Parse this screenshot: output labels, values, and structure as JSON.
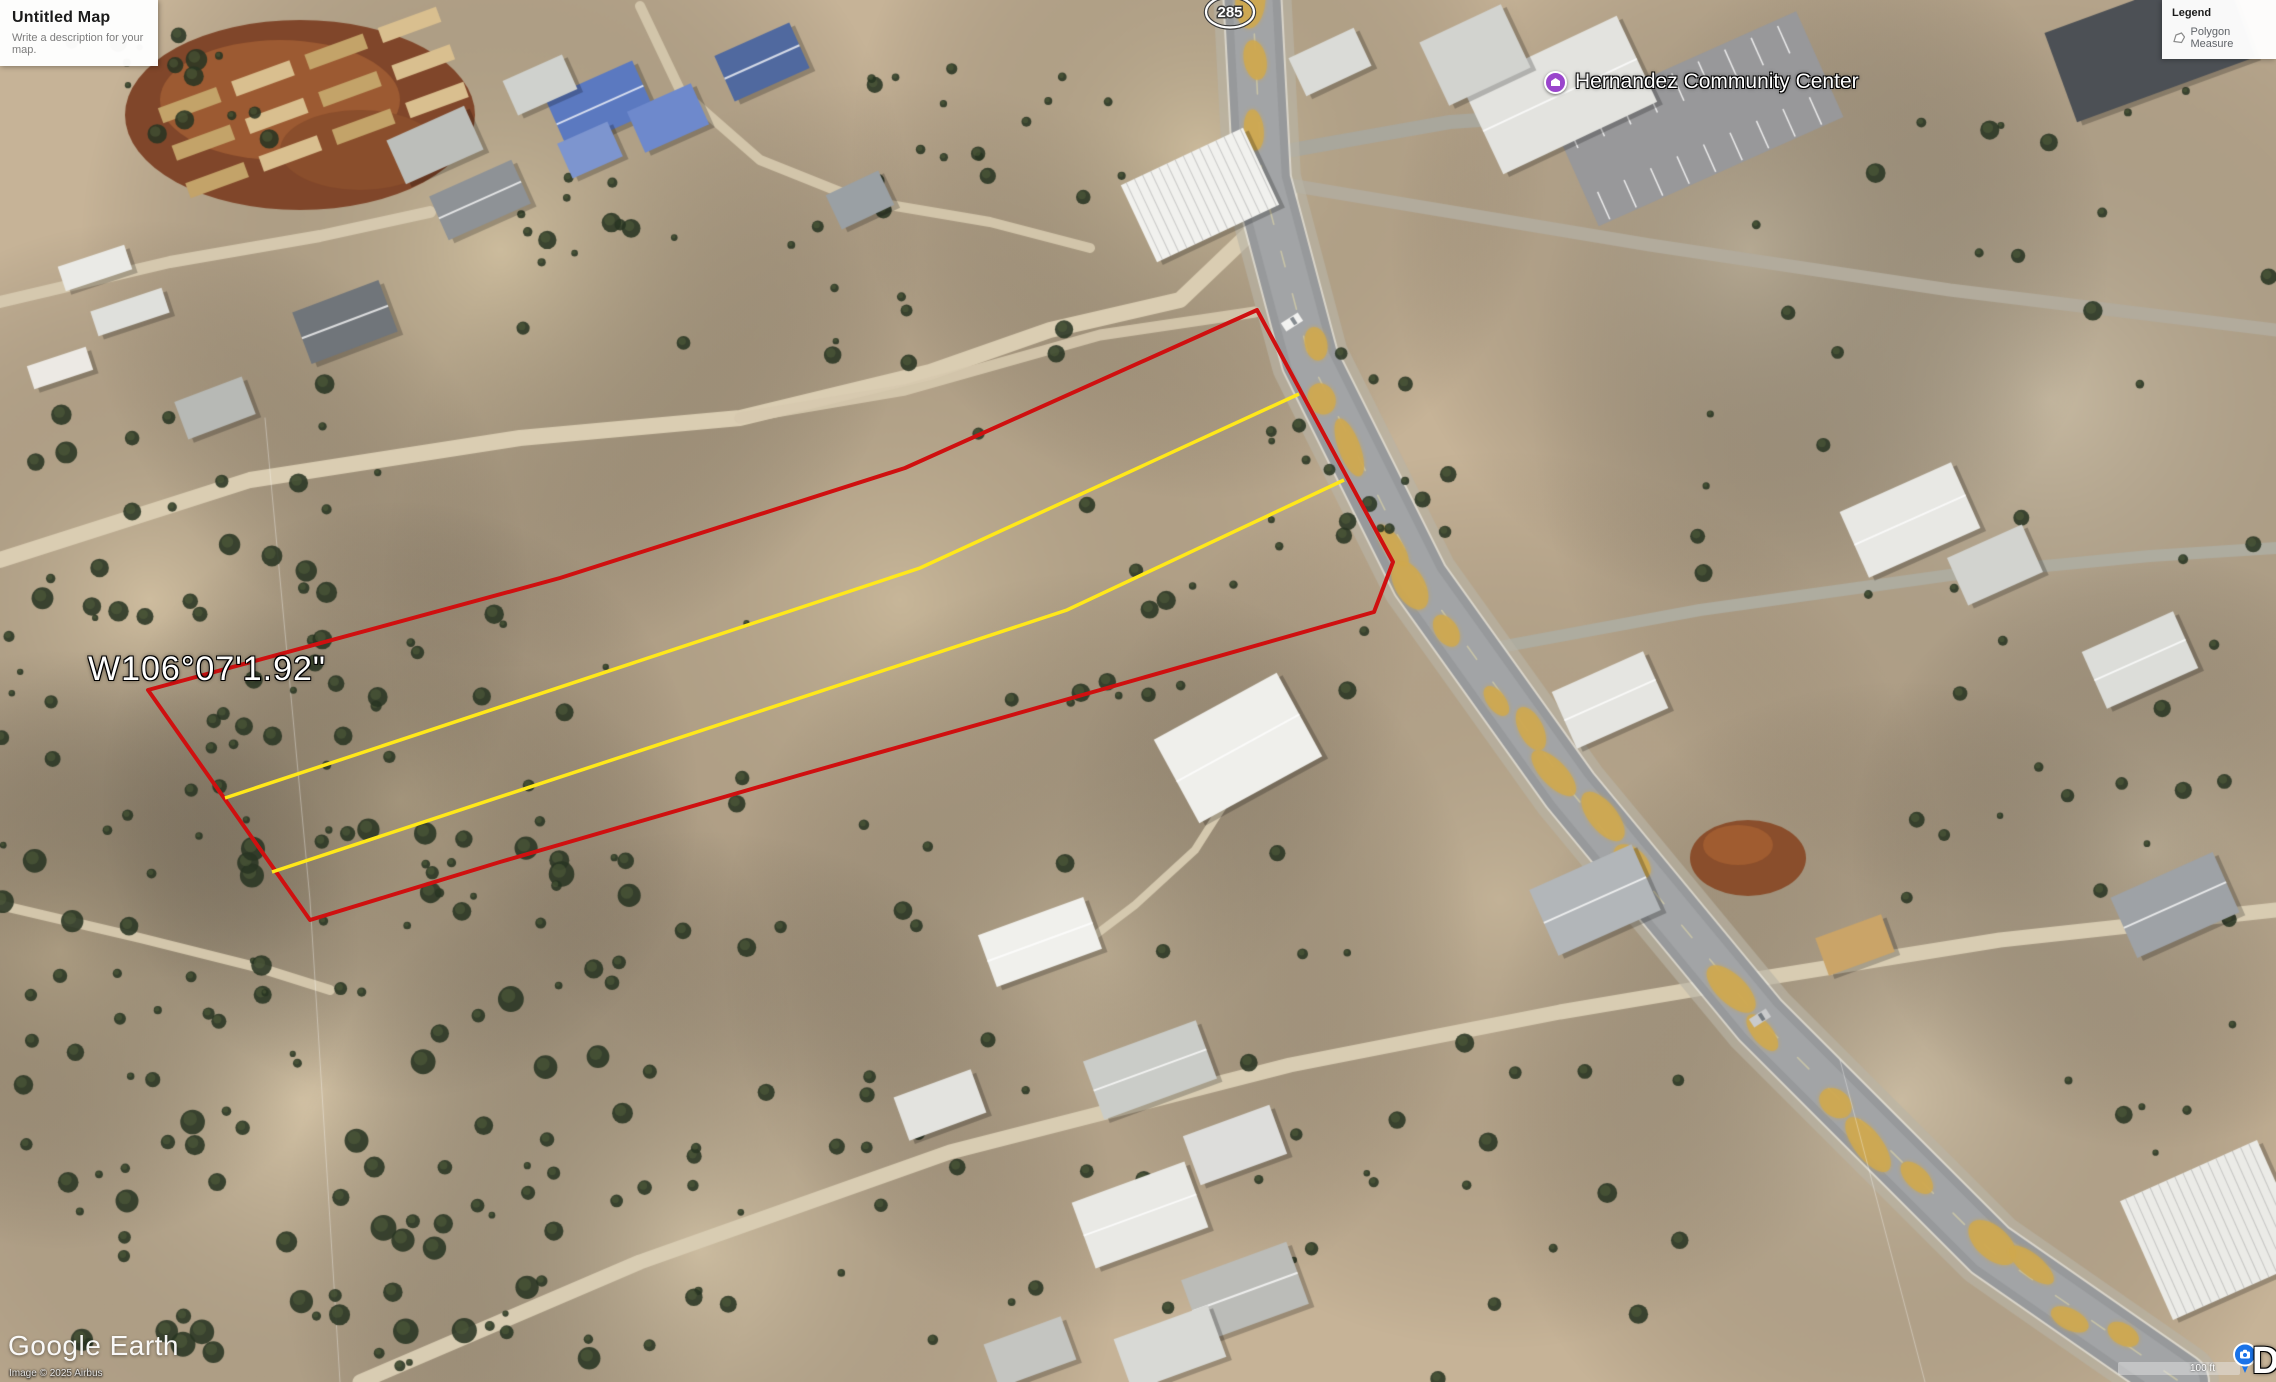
{
  "title_panel": {
    "title": "Untitled Map",
    "subtitle": "Write a description for your map."
  },
  "legend_panel": {
    "title": "Legend",
    "item_label": "Polygon Measure"
  },
  "labels": {
    "place_name": "Hernandez Community Center",
    "coordinate": "W106°07'1.92\"",
    "route_shield": "285"
  },
  "footer": {
    "logo": "Google Earth",
    "imagery_credit": "Image © 2025 Airbus",
    "scale_label": "100 ft",
    "edge_text_fragment": "D"
  },
  "colors": {
    "parcel_outline": "#cf1010",
    "lot_lines": "#ffe81a",
    "place_pin": "#9a45cc",
    "photo_pin": "#1a73e8",
    "road_overlay": "#cfa84e"
  }
}
